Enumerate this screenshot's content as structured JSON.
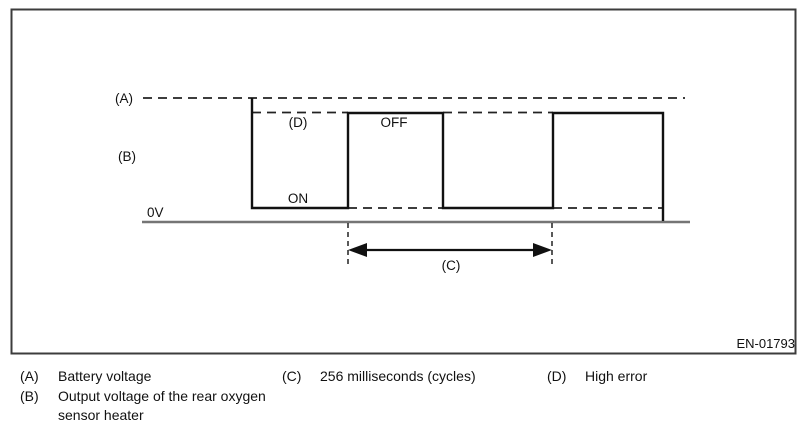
{
  "figure": {
    "ref_code": "EN-01793",
    "labels": {
      "battery": "(A)",
      "output": "(B)",
      "cycle": "(C)",
      "high_error": "(D)",
      "off": "OFF",
      "on": "ON",
      "zero_volts": "0V"
    }
  },
  "legend": {
    "items": [
      {
        "key": "(A)",
        "text": "Battery voltage"
      },
      {
        "key": "(B)",
        "text_line1": "Output voltage of the rear oxygen",
        "text_line2": "sensor heater"
      },
      {
        "key": "(C)",
        "text": "256 milliseconds (cycles)"
      },
      {
        "key": "(D)",
        "text": "High error"
      }
    ]
  },
  "colors": {
    "ink": "#111111",
    "axis_gray": "#757575",
    "border_gray": "#3c3c3c",
    "background": "#ffffff"
  }
}
